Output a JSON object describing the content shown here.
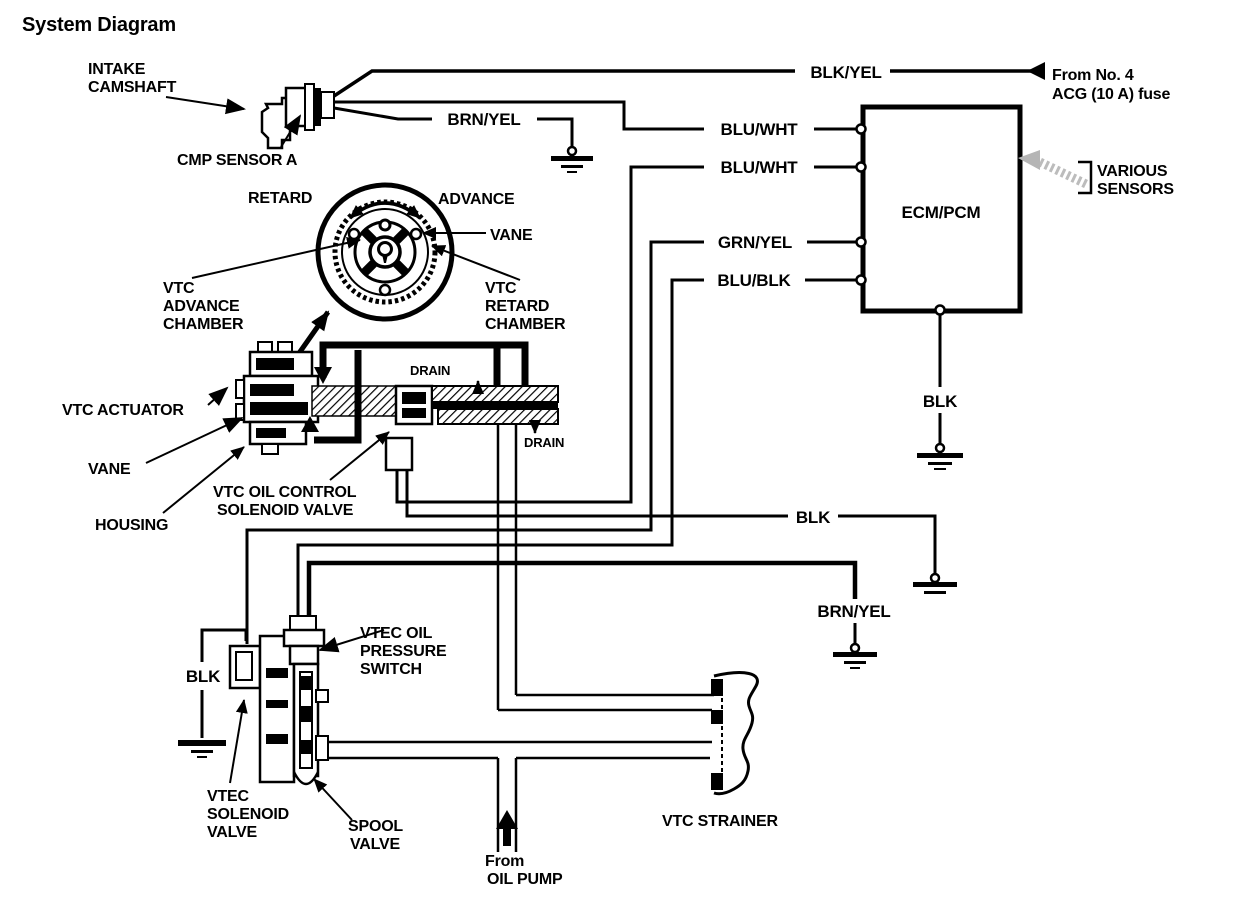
{
  "title": "System Diagram",
  "colors": {
    "ink": "#000000",
    "background": "#ffffff",
    "ghost_arrow": "#b5b5b5"
  },
  "power_source": {
    "lines": [
      "From No. 4",
      "ACG (10 A) fuse"
    ]
  },
  "ecm": {
    "label": "ECM/PCM",
    "ground_label": "BLK"
  },
  "various_sensors": {
    "lines": [
      "VARIOUS",
      "SENSORS"
    ]
  },
  "wires": {
    "blk_yel": "BLK/YEL",
    "brn_yel_cmp": "BRN/YEL",
    "blu_wht_1": "BLU/WHT",
    "blu_wht_2": "BLU/WHT",
    "grn_yel": "GRN/YEL",
    "blu_blk": "BLU/BLK",
    "blk_solenoid": "BLK",
    "brn_yel_switch": "BRN/YEL",
    "blk_vtec": "BLK"
  },
  "components": {
    "intake_camshaft": {
      "lines": [
        "INTAKE",
        "CAMSHAFT"
      ]
    },
    "cmp_sensor": {
      "label": "CMP SENSOR A"
    },
    "rotor": {
      "retard": "RETARD",
      "advance": "ADVANCE",
      "vane": "VANE",
      "advance_chamber": {
        "lines": [
          "VTC",
          "ADVANCE",
          "CHAMBER"
        ]
      },
      "retard_chamber": {
        "lines": [
          "VTC",
          "RETARD",
          "CHAMBER"
        ]
      }
    },
    "actuator": {
      "label": "VTC ACTUATOR",
      "vane": "VANE",
      "housing": "HOUSING"
    },
    "oil_control_valve": {
      "lines": [
        "VTC OIL CONTROL",
        "SOLENOID VALVE"
      ],
      "drain_top": "DRAIN",
      "drain_bottom": "DRAIN"
    },
    "pressure_switch": {
      "lines": [
        "VTEC OIL",
        "PRESSURE",
        "SWITCH"
      ]
    },
    "vtec_solenoid_valve": {
      "lines": [
        "VTEC",
        "SOLENOID",
        "VALVE"
      ]
    },
    "spool_valve": {
      "lines": [
        "SPOOL",
        "VALVE"
      ]
    },
    "oil_pump": {
      "lines": [
        "From",
        "OIL PUMP"
      ]
    },
    "strainer": {
      "label": "VTC STRAINER"
    }
  }
}
